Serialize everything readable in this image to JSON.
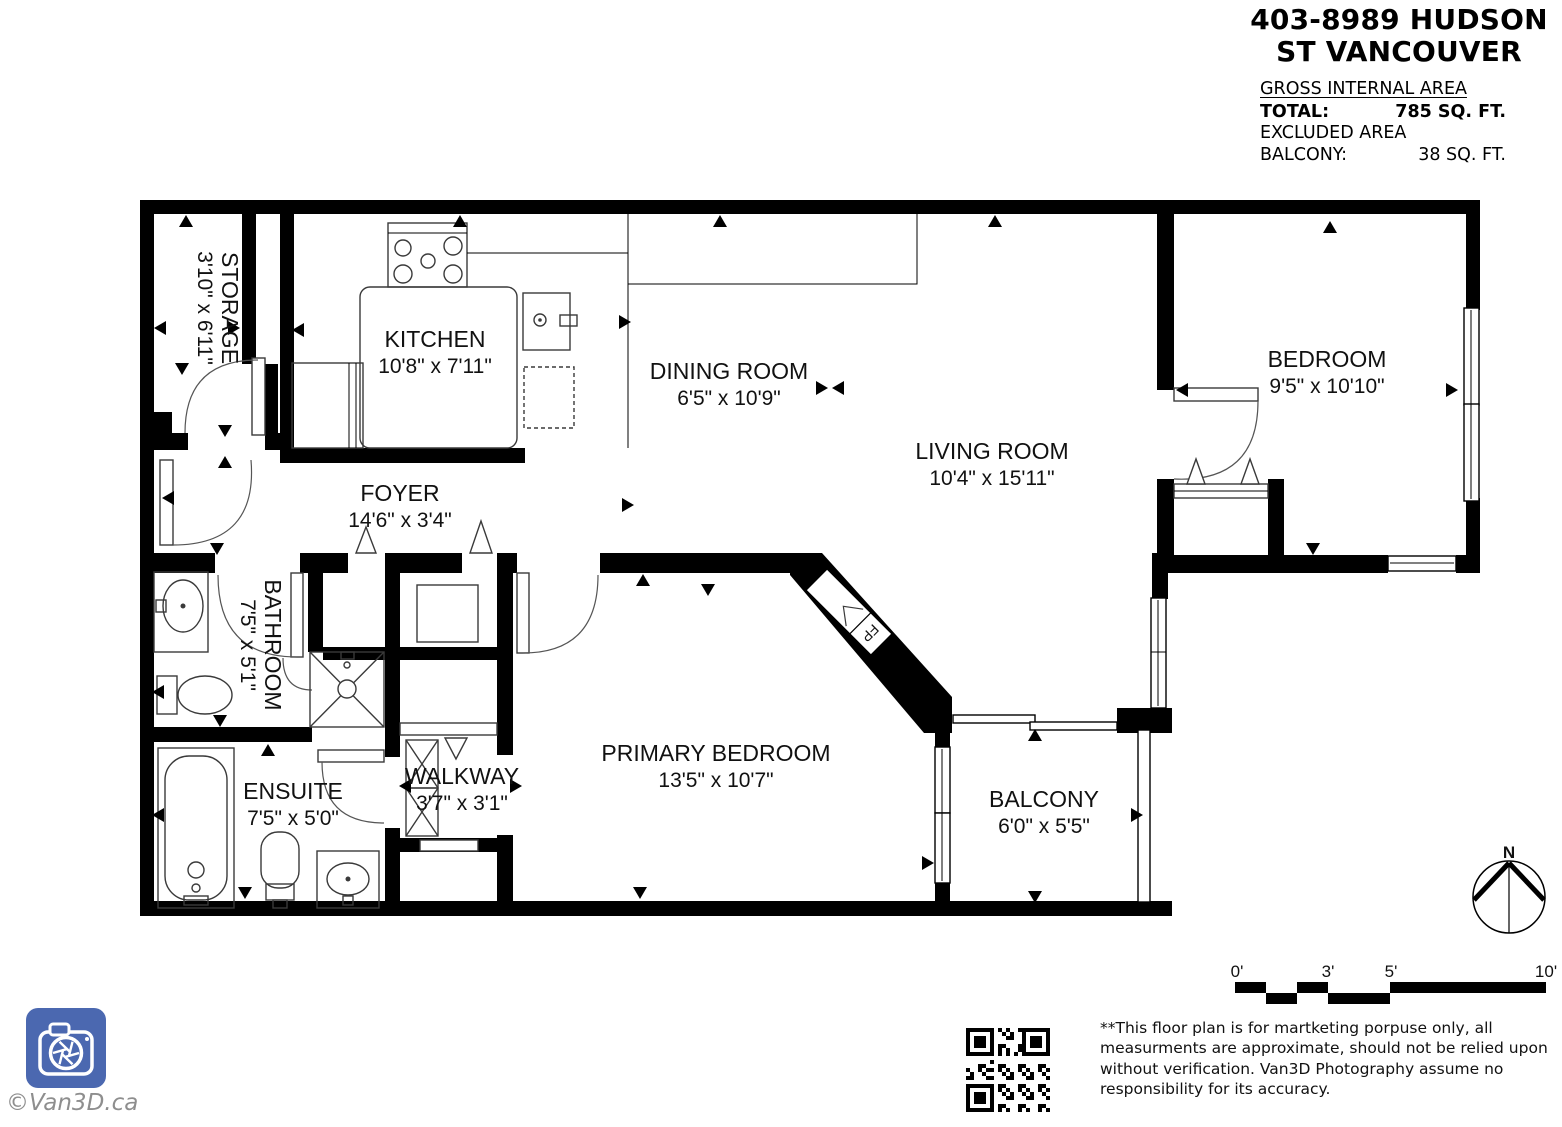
{
  "title": {
    "line1": "403-8989 HUDSON",
    "line2": "ST VANCOUVER"
  },
  "area_summary": {
    "heading": "GROSS INTERNAL AREA",
    "rows": [
      {
        "label": "TOTAL:",
        "value": "785 SQ. FT."
      },
      {
        "label": "EXCLUDED AREA",
        "value": ""
      },
      {
        "label": "BALCONY:",
        "value": "38 SQ. FT."
      }
    ]
  },
  "rooms": {
    "storage": {
      "name": "STORAGE",
      "dims": "3'10\" x 6'11\""
    },
    "kitchen": {
      "name": "KITCHEN",
      "dims": "10'8\" x 7'11\""
    },
    "dining": {
      "name": "DINING ROOM",
      "dims": "6'5\" x 10'9\""
    },
    "living": {
      "name": "LIVING ROOM",
      "dims": "10'4\" x 15'11\""
    },
    "bedroom": {
      "name": "BEDROOM",
      "dims": "9'5\" x 10'10\""
    },
    "foyer": {
      "name": "FOYER",
      "dims": "14'6\" x 3'4\""
    },
    "bathroom": {
      "name": "BATHROOM",
      "dims": "7'5\" x 5'1\""
    },
    "ensuite": {
      "name": "ENSUITE",
      "dims": "7'5\" x 5'0\""
    },
    "walkway": {
      "name": "WALKWAY",
      "dims": "3'7\" x 3'1\""
    },
    "primary_bedroom": {
      "name": "PRIMARY BEDROOM",
      "dims": "13'5\" x 10'7\""
    },
    "balcony": {
      "name": "BALCONY",
      "dims": "6'0\" x 5'5\""
    }
  },
  "annotations": {
    "fireplace": "FP",
    "compass_north": "N"
  },
  "scale_bar": {
    "labels": [
      "0'",
      "3'",
      "5'",
      "10'"
    ]
  },
  "footer": {
    "disclaimer": "**This floor plan is for martketing porpuse only, all measurments are approximate, should not be relied upon without verification. Van3D Photography assume no responsibility for its accuracy.",
    "watermark": "©Van3D.ca"
  },
  "colors": {
    "wall": "#000000",
    "logo_blue": "#4b68b0",
    "text": "#111111",
    "watermark_gray": "#8e8e8e"
  }
}
